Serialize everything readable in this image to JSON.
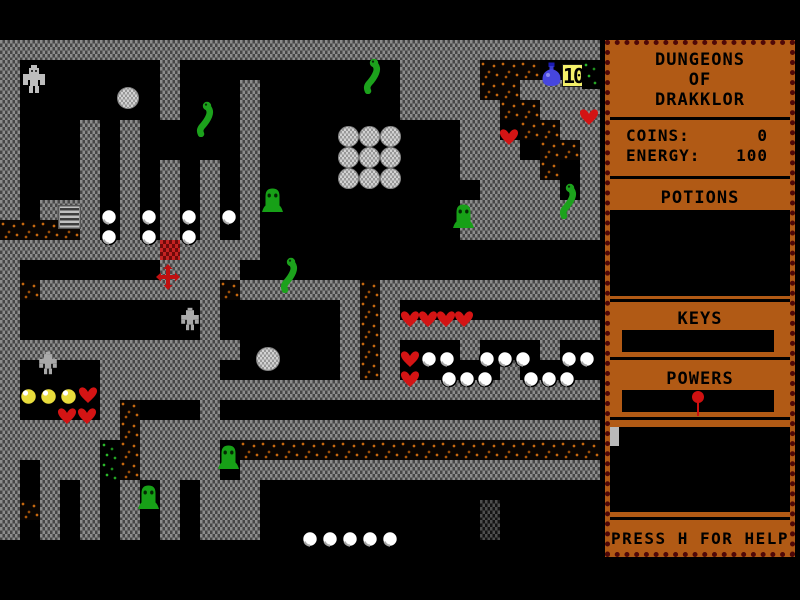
{
  "window": {
    "width": 800,
    "height": 600
  },
  "sidebar": {
    "title_lines": [
      "DUNGEONS",
      "OF",
      "DRAKKLOR"
    ],
    "stats": [
      {
        "label": "COINS:",
        "value": "0"
      },
      {
        "label": "ENERGY:",
        "value": "100"
      }
    ],
    "potions_heading": "POTIONS",
    "keys_heading": "KEYS",
    "powers_heading": "POWERS",
    "help_text": "PRESS H FOR HELP"
  },
  "hud": {
    "coin_badge": "10"
  },
  "colors": {
    "panel": "#b15a15",
    "panel_border": "#4e0707",
    "wall_base": "#8d8d8d",
    "wall_speck": "#474747",
    "rubble_orange": "#c8690f",
    "moss_green": "#2bb62b",
    "heart_red": "#d41414",
    "slime_green": "#17a017",
    "snake_green": "#1ca21c",
    "gold": "#e8dc3c",
    "potion_blue": "#4646de",
    "badge_bg": "#f4f06a"
  },
  "map": {
    "tile_size": 20,
    "columns": 30,
    "visible_rows": 30,
    "legend": {
      "W": "wall",
      ".": "floor",
      "r": "rubble",
      "g": "moss",
      "d": "dark-wall",
      "C": "red-brick"
    },
    "rows": [
      "..............................",
      "..............................",
      "WWWWWWWWWWWWWWWWWWWWWWWWWWWWWW",
      "W.......W...........WWWWrrr...",
      "W.......W...W.......WWWWrrWWWW",
      "W.......W...W.......WWWWWrrWWW",
      "W...W.W.....W..........WW.rrWW",
      "W...W.W.....W..........WWW.rrW",
      "W...W.W.W.W.W..........WWWWr.W",
      "W...W.W.W.W.W...........WWWW.W",
      "W.WWW.W.W.W.W..........WWWWWWW",
      "rrrrW.W.W.W.W..........WWWWWWW",
      "WWWWWWWWCWWWW.................",
      "W.......WWWW..................",
      "WrWWWWWWWWWrWWWWWWrWWWWWWWWWWW",
      "W.........W......WrW..........",
      "W.........W......WrWWWWWWWWWWW",
      "WWWWWWWWWWWW.....WrW...W...W..",
      "W....WWWWWW......WrW.....W....",
      "W....WWWWWWWWWWWWWWWWWWWWWWWWW",
      "W....Wr...W...................",
      "WWWWWWrWWWWWWWWWWWWWWWWWWWWWWW",
      "WWWWWgrWWWW.rrrrrrrrrrrrrrrrrr",
      "W.WWWgrWWWW.WWWWWWWWWWWWWWWWWW",
      "W.W.W.W.W.WWW.................",
      "WrW.W.W.W.WWW...........d.....",
      "W.W.W.W.W.WWW...........d.....",
      "..............................",
      "..............................",
      ".............................."
    ]
  },
  "sprites": [
    {
      "t": "player",
      "x": 19,
      "y": 64
    },
    {
      "t": "golem",
      "x": 178,
      "y": 306
    },
    {
      "t": "golem",
      "x": 36,
      "y": 350
    },
    {
      "t": "ball",
      "x": 117,
      "y": 87,
      "s": 22
    },
    {
      "t": "ball",
      "x": 338,
      "y": 126,
      "s": 21
    },
    {
      "t": "ball",
      "x": 359,
      "y": 126,
      "s": 21
    },
    {
      "t": "ball",
      "x": 380,
      "y": 126,
      "s": 21
    },
    {
      "t": "ball",
      "x": 338,
      "y": 147,
      "s": 21
    },
    {
      "t": "ball",
      "x": 359,
      "y": 147,
      "s": 21
    },
    {
      "t": "ball",
      "x": 380,
      "y": 147,
      "s": 21
    },
    {
      "t": "ball",
      "x": 338,
      "y": 168,
      "s": 21
    },
    {
      "t": "ball",
      "x": 359,
      "y": 168,
      "s": 21
    },
    {
      "t": "ball",
      "x": 380,
      "y": 168,
      "s": 21
    },
    {
      "t": "ball",
      "x": 256,
      "y": 347,
      "s": 24
    },
    {
      "t": "ladder",
      "x": 58,
      "y": 205
    },
    {
      "t": "cross",
      "x": 156,
      "y": 264
    },
    {
      "t": "potion",
      "x": 540,
      "y": 62
    },
    {
      "t": "coin-badge",
      "x": 562,
      "y": 64
    },
    {
      "t": "sparkle",
      "x": 582,
      "y": 60
    },
    {
      "t": "snake",
      "x": 360,
      "y": 57
    },
    {
      "t": "snake",
      "x": 193,
      "y": 100
    },
    {
      "t": "snake",
      "x": 277,
      "y": 256
    },
    {
      "t": "snake",
      "x": 556,
      "y": 182
    },
    {
      "t": "slime",
      "x": 261,
      "y": 186
    },
    {
      "t": "slime",
      "x": 452,
      "y": 202
    },
    {
      "t": "slime",
      "x": 217,
      "y": 443
    },
    {
      "t": "slime",
      "x": 137,
      "y": 483
    },
    {
      "t": "heart",
      "x": 499,
      "y": 128
    },
    {
      "t": "heart",
      "x": 579,
      "y": 108
    },
    {
      "t": "heart",
      "x": 400,
      "y": 310
    },
    {
      "t": "heart",
      "x": 418,
      "y": 310
    },
    {
      "t": "heart",
      "x": 436,
      "y": 310
    },
    {
      "t": "heart",
      "x": 454,
      "y": 310
    },
    {
      "t": "heart",
      "x": 400,
      "y": 350
    },
    {
      "t": "heart",
      "x": 400,
      "y": 370
    },
    {
      "t": "heart",
      "x": 78,
      "y": 386
    },
    {
      "t": "heart",
      "x": 57,
      "y": 407
    },
    {
      "t": "heart",
      "x": 77,
      "y": 407
    },
    {
      "t": "pearl",
      "x": 100,
      "y": 208
    },
    {
      "t": "pearl",
      "x": 100,
      "y": 228
    },
    {
      "t": "pearl",
      "x": 140,
      "y": 208
    },
    {
      "t": "pearl",
      "x": 140,
      "y": 228
    },
    {
      "t": "pearl",
      "x": 180,
      "y": 208
    },
    {
      "t": "pearl",
      "x": 180,
      "y": 228
    },
    {
      "t": "pearl",
      "x": 220,
      "y": 208
    },
    {
      "t": "pearl",
      "x": 420,
      "y": 350
    },
    {
      "t": "pearl",
      "x": 438,
      "y": 350
    },
    {
      "t": "pearl",
      "x": 478,
      "y": 350
    },
    {
      "t": "pearl",
      "x": 496,
      "y": 350
    },
    {
      "t": "pearl",
      "x": 514,
      "y": 350
    },
    {
      "t": "pearl",
      "x": 560,
      "y": 350
    },
    {
      "t": "pearl",
      "x": 578,
      "y": 350
    },
    {
      "t": "pearl",
      "x": 440,
      "y": 370
    },
    {
      "t": "pearl",
      "x": 458,
      "y": 370
    },
    {
      "t": "pearl",
      "x": 476,
      "y": 370
    },
    {
      "t": "pearl",
      "x": 522,
      "y": 370
    },
    {
      "t": "pearl",
      "x": 540,
      "y": 370
    },
    {
      "t": "pearl",
      "x": 558,
      "y": 370
    },
    {
      "t": "pearl",
      "x": 301,
      "y": 530
    },
    {
      "t": "pearl",
      "x": 321,
      "y": 530
    },
    {
      "t": "pearl",
      "x": 341,
      "y": 530
    },
    {
      "t": "pearl",
      "x": 361,
      "y": 530
    },
    {
      "t": "pearl",
      "x": 381,
      "y": 530
    },
    {
      "t": "gold",
      "x": 19,
      "y": 387
    },
    {
      "t": "gold",
      "x": 39,
      "y": 387
    },
    {
      "t": "gold",
      "x": 59,
      "y": 387
    }
  ]
}
